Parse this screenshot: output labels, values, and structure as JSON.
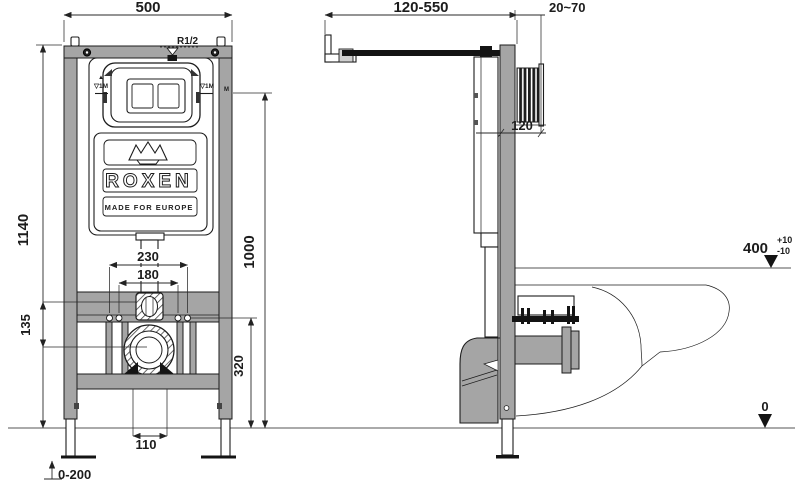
{
  "front": {
    "dims": {
      "width": "500",
      "height": "1140",
      "flush_pipe_spacing": "230",
      "stud_spacing": "180",
      "offset": "135",
      "outlet_height": "320",
      "flush_bend": "1000",
      "drain_gap": "110",
      "feet_adjust": "0-200"
    },
    "labels": {
      "water_inlet": "R1/2",
      "tank_mark_arrow": "▲",
      "tank_mark_left": "▽1M",
      "tank_mark_right": "▽1M",
      "meter_mark": "M"
    },
    "logo": {
      "brand": "ROXEN",
      "tagline": "MADE FOR EUROPE"
    }
  },
  "side": {
    "dims": {
      "arm_adjust": "120-550",
      "wall_clearance": "20~70",
      "bend_depth": "120",
      "bowl_height": "400",
      "bowl_tol_plus": "+10",
      "bowl_tol_minus": "-10",
      "floor_level": "0"
    }
  },
  "colors": {
    "frame_gray": "#a5a5a5",
    "ink": "#1c1c1c"
  }
}
